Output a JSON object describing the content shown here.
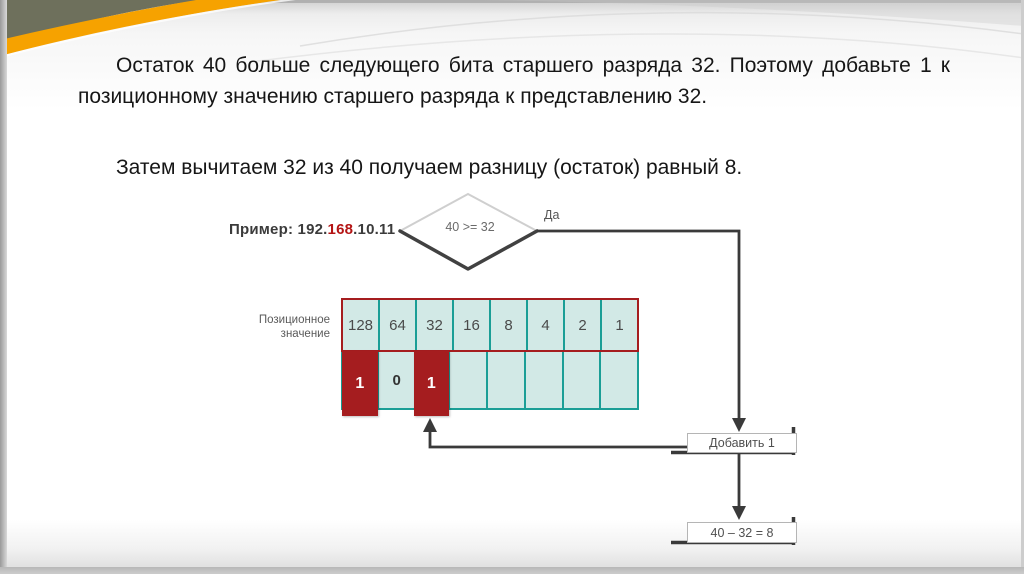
{
  "slide": {
    "paragraph1": "Остаток 40 больше следующего бита старшего разряда 32. Поэтому добавьте 1 к позиционному значению старшего разряда к представлению 32.",
    "paragraph2": "Затем вычитаем 32 из 40 получаем разницу (остаток) равный 8."
  },
  "diagram": {
    "example_label": {
      "prefix": "Пример: 192.",
      "highlight": "168",
      "suffix": ".10.11"
    },
    "decision": {
      "condition": "40 >= 32",
      "branch_label": "Да"
    },
    "table": {
      "row_label_line1": "Позиционное",
      "row_label_line2": "значение",
      "position_values": [
        "128",
        "64",
        "32",
        "16",
        "8",
        "4",
        "2",
        "1"
      ],
      "bits": [
        "1",
        "0",
        "1",
        "",
        "",
        "",
        "",
        ""
      ],
      "active_bit_indices": [
        0,
        2
      ]
    },
    "boxes": {
      "add_one": "Добавить 1",
      "subtract": "40 – 32 = 8"
    },
    "colors": {
      "cell_bg": "#d2e9e6",
      "cell_border": "#1b9e96",
      "active_bit_bg": "#a51d1f",
      "top_row_border": "#a51d1f",
      "flow_line": "#3a3a3a",
      "highlight_red": "#b41414",
      "accent_orange": "#f6a200",
      "band_olive": "#6e705c"
    }
  }
}
